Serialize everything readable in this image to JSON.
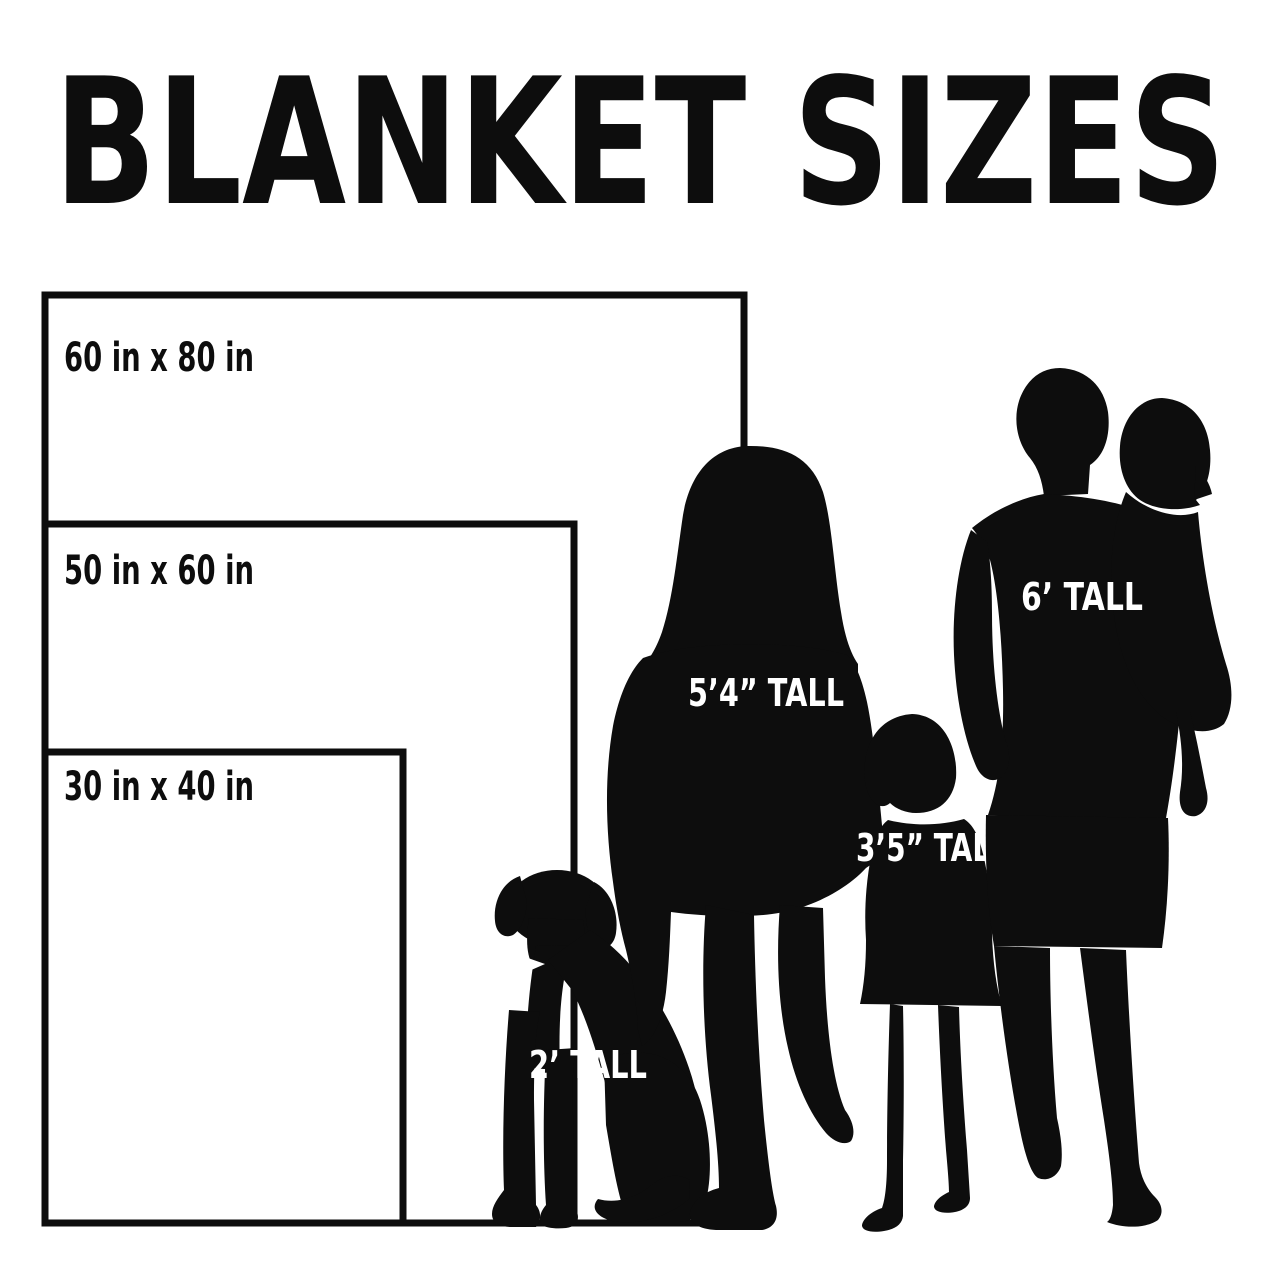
{
  "title": "BLANKET SIZES",
  "blankets": [
    {
      "id": "60x80",
      "label": "60 in x 80 in",
      "width_in": 60,
      "height_in": 80
    },
    {
      "id": "50x60",
      "label": "50 in x 60 in",
      "width_in": 50,
      "height_in": 60
    },
    {
      "id": "30x40",
      "label": "30 in x 40 in",
      "width_in": 30,
      "height_in": 40
    }
  ],
  "figures": [
    {
      "id": "dog",
      "label": "2’ TALL"
    },
    {
      "id": "woman",
      "label": "5’4” TALL"
    },
    {
      "id": "child",
      "label": "3’5” TALL"
    },
    {
      "id": "man",
      "label": "6’ TALL"
    }
  ],
  "colors": {
    "ink": "#0d0d0d",
    "background": "#ffffff",
    "figure_label_text": "#ffffff"
  }
}
